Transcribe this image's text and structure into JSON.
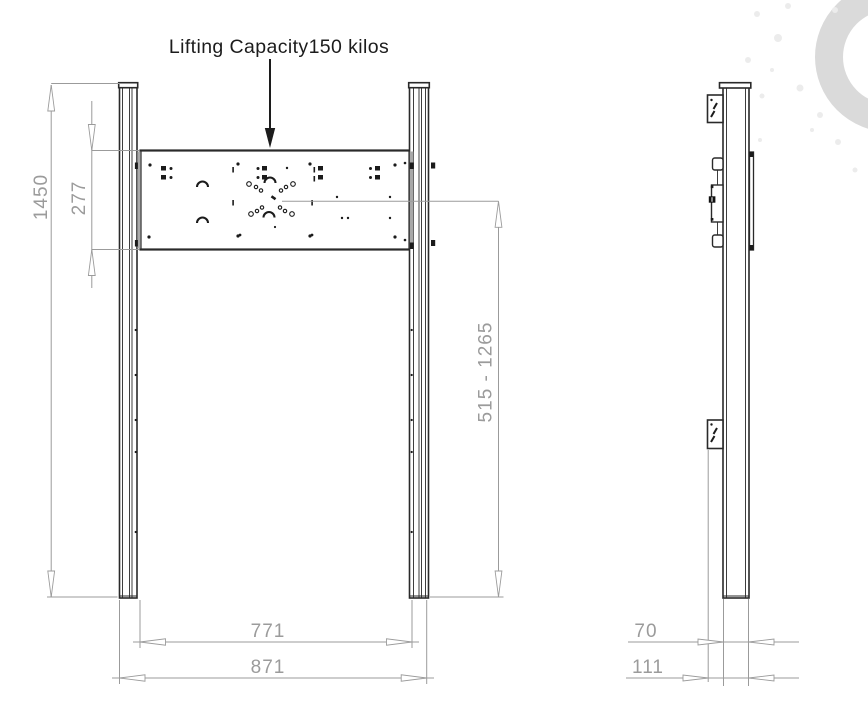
{
  "annotation": {
    "lifting_capacity": "Lifting Capacity150 kilos"
  },
  "dimensions": {
    "total_height": "1450",
    "bracket_height": "277",
    "lift_range": "515 - 1265",
    "inner_width": "771",
    "outer_width": "871",
    "column_depth": "70",
    "overall_depth": "111"
  },
  "colors": {
    "part_line": "#2a2a2a",
    "dimension_line": "#9b9b9b",
    "annotation_text": "#1c1c1c",
    "watermark_ring": "#dadada",
    "plate_end_shade": "#a9a9a9",
    "background": "#ffffff"
  }
}
